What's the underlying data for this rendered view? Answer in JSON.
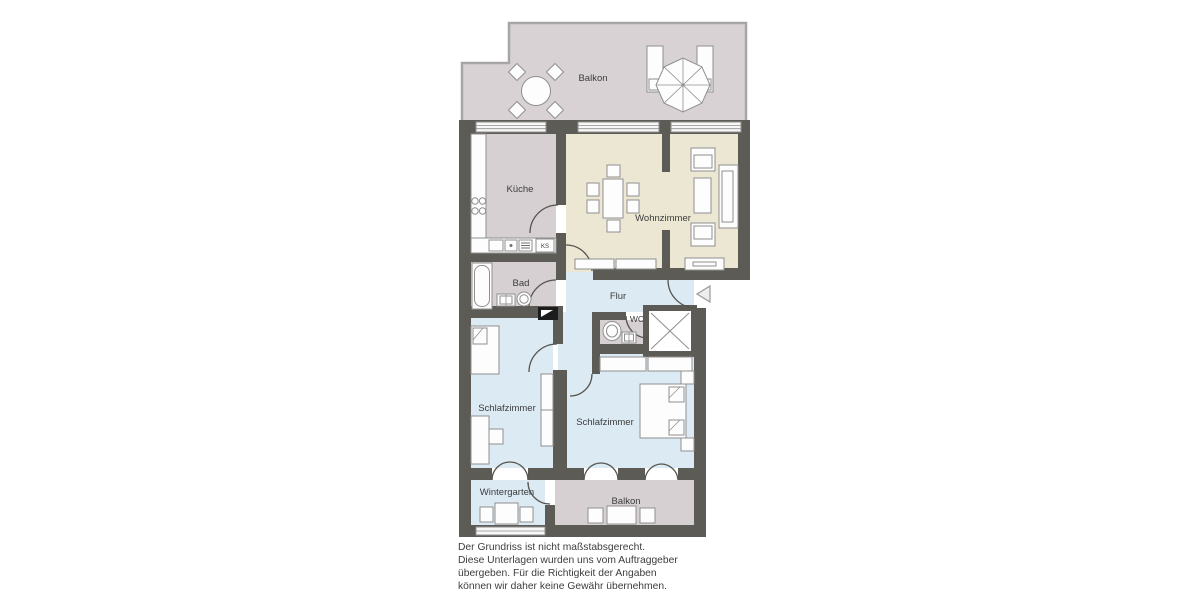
{
  "plan": {
    "type": "apartment-floorplan",
    "rooms": {
      "balkon_top": {
        "label": "Balkon"
      },
      "kueche": {
        "label": "Küche"
      },
      "wohnzimmer": {
        "label": "Wohnzimmer"
      },
      "bad": {
        "label": "Bad"
      },
      "flur": {
        "label": "Flur"
      },
      "wc": {
        "label": "WC"
      },
      "schlafzimmer_left": {
        "label": "Schlafzimmer"
      },
      "schlafzimmer_right": {
        "label": "Schlafzimmer"
      },
      "wintergarten": {
        "label": "Wintergarten"
      },
      "balkon_bottom": {
        "label": "Balkon"
      }
    },
    "kitchen": {
      "fridge_label": "KS"
    },
    "colors": {
      "wall": "#5c5b55",
      "service_rooms": "#d6d0d3",
      "living_room": "#ece7d3",
      "bedrooms_hall": "#dceaf4",
      "railing": "#a8a5a8",
      "background": "#ffffff"
    }
  },
  "disclaimer": {
    "line1": "Der Grundriss ist nicht maßstabsgerecht.",
    "line2": "Diese Unterlagen wurden uns vom Auftraggeber",
    "line3": "übergeben. Für die Richtigkeit der Angaben",
    "line4": "können wir daher keine Gewähr übernehmen."
  }
}
